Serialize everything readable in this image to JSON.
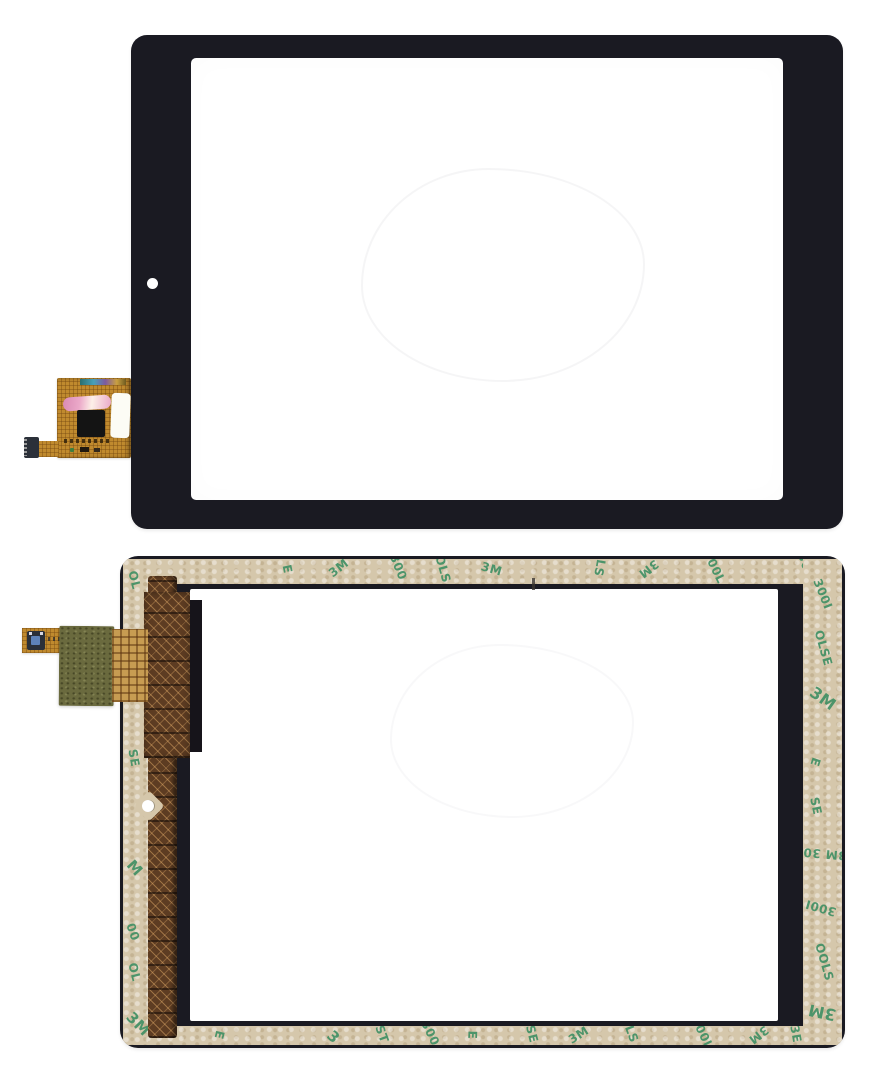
{
  "palette": {
    "bg": "#ffffff",
    "bezel": "#1a1a22",
    "screen": "#ffffff",
    "tape": "#d5c7ab",
    "tape_print": "#3e8f63",
    "flex_gold": "#c08a2e",
    "flex_brown": "#5d3c22",
    "olive": "#6a6a3e",
    "connector": "#2b3039",
    "label_pink": "#eba9c9"
  },
  "tape_print": {
    "brand": "3M",
    "series": "300LSE",
    "fragments": {
      "back_top": [
        {
          "t": "E",
          "x": 160,
          "y": 3,
          "r": 78
        },
        {
          "t": "3M",
          "x": 205,
          "y": 2,
          "r": -38
        },
        {
          "t": "300",
          "x": 262,
          "y": 1,
          "r": 68
        },
        {
          "t": "OLS",
          "x": 306,
          "y": 3,
          "r": 74
        },
        {
          "t": "3M",
          "x": 358,
          "y": 3,
          "r": 16
        },
        {
          "t": "LS",
          "x": 468,
          "y": 2,
          "r": 100
        },
        {
          "t": "3M",
          "x": 515,
          "y": 3,
          "r": 142
        },
        {
          "t": "300L",
          "x": 574,
          "y": 1,
          "r": 64
        },
        {
          "t": "300I",
          "x": 668,
          "y": 2,
          "r": 70
        }
      ],
      "back_right": [
        {
          "t": "300I",
          "x": 4,
          "y": 28,
          "r": 68
        },
        {
          "t": "OLSE",
          "x": 2,
          "y": 82,
          "r": 74
        },
        {
          "t": "3M",
          "x": 6,
          "y": 130,
          "r": 36,
          "s": 16
        },
        {
          "t": "E",
          "x": 8,
          "y": 196,
          "r": 108
        },
        {
          "t": "SE",
          "x": 4,
          "y": 240,
          "r": 78
        },
        {
          "t": "3M 30",
          "x": 0,
          "y": 288,
          "r": 185
        },
        {
          "t": "300I",
          "x": 2,
          "y": 342,
          "r": 196
        },
        {
          "t": "OOLS",
          "x": 2,
          "y": 396,
          "r": 74
        },
        {
          "t": "3M",
          "x": 5,
          "y": 444,
          "r": 192,
          "s": 16
        }
      ],
      "back_left": [
        {
          "t": "OL",
          "x": 2,
          "y": 14,
          "r": 76
        },
        {
          "t": "SE",
          "x": 2,
          "y": 192,
          "r": 80
        },
        {
          "t": "M",
          "x": 4,
          "y": 300,
          "r": 48,
          "s": 15
        },
        {
          "t": "00",
          "x": 1,
          "y": 366,
          "r": 70
        },
        {
          "t": "OL",
          "x": 2,
          "y": 406,
          "r": 76
        },
        {
          "t": "3M",
          "x": 2,
          "y": 456,
          "r": 46,
          "s": 15
        }
      ],
      "back_bottom": [
        {
          "t": "E",
          "x": 92,
          "y": 2,
          "r": 104
        },
        {
          "t": "3",
          "x": 205,
          "y": 2,
          "r": 44,
          "s": 15
        },
        {
          "t": "ST",
          "x": 250,
          "y": 1,
          "r": 70
        },
        {
          "t": "300",
          "x": 294,
          "y": 0,
          "r": 64
        },
        {
          "t": "E",
          "x": 345,
          "y": 2,
          "r": 92
        },
        {
          "t": "SE",
          "x": 400,
          "y": 1,
          "r": 76
        },
        {
          "t": "3M",
          "x": 445,
          "y": 2,
          "r": -32
        },
        {
          "t": "LS",
          "x": 500,
          "y": 1,
          "r": 70
        },
        {
          "t": "300L",
          "x": 562,
          "y": 0,
          "r": 64
        },
        {
          "t": "3M",
          "x": 625,
          "y": 2,
          "r": 142
        },
        {
          "t": "3E",
          "x": 664,
          "y": 1,
          "r": 80
        }
      ]
    }
  }
}
